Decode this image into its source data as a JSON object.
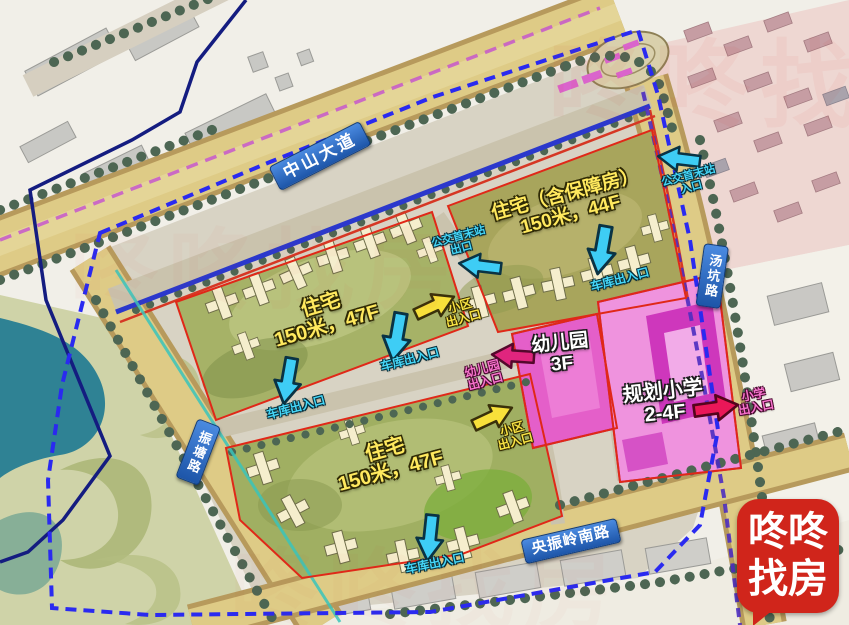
{
  "roads": {
    "zhongshan_avenue": "中山大道",
    "tangkeng_road": "汤坑路",
    "zhentang_road": "振塘路",
    "yangzhenling_south_road": "央振岭南路"
  },
  "parcels": {
    "block_a": {
      "line1": "住宅（含保障房）",
      "line2": "150米，44F"
    },
    "block_b": {
      "line1": "住宅",
      "line2": "150米，47F"
    },
    "block_c": {
      "line1": "住宅",
      "line2": "150米，47F"
    },
    "kindergarten": {
      "line1": "幼儿园",
      "line2": "3F"
    },
    "school": {
      "line1": "规划小学",
      "line2": "2-4F"
    }
  },
  "entrances": {
    "garage": "车库出入口",
    "community": {
      "line1": "小区",
      "line2": "出入口"
    },
    "bus_exit": {
      "line1": "公交首末站",
      "line2": "出口"
    },
    "bus_entry": {
      "line1": "公交首末站",
      "line2": "入口"
    },
    "kindergarten": {
      "line1": "幼儿园",
      "line2": "出入口"
    },
    "school": {
      "line1": "小学",
      "line2": "出入口"
    }
  },
  "watermark": {
    "text": "咚咚找房"
  },
  "logo": {
    "line1": "咚咚",
    "line2": "找房"
  },
  "colors": {
    "arrow_cyan": "#3ecdf5",
    "arrow_yellow": "#f8e03a",
    "arrow_magenta": "#e0257e",
    "arrow_red_pink": "#ea1758",
    "parcel_label_yellow": "#ffe95e",
    "road_sign_blue": "#2a6bd2",
    "kindergarten_magenta": "#e45fc9",
    "school_pink": "#ef93de",
    "boundary_dashed_blue": "#2a2af0",
    "logo_red": "#d0251b",
    "water_teal": "#2f8294"
  }
}
